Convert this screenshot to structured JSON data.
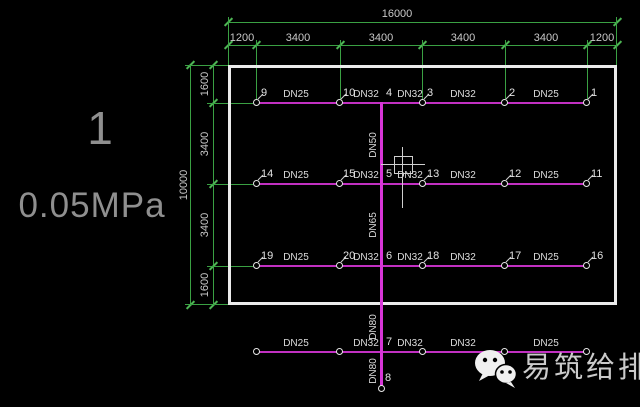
{
  "drawing": {
    "annotation": {
      "riser_id": "1",
      "pressure": "0.05MPa"
    },
    "dims_top": {
      "overall": "16000",
      "segments": [
        "1200",
        "3400",
        "3400",
        "3400",
        "3400",
        "1200"
      ]
    },
    "dims_left": {
      "overall": "10000",
      "segments": [
        "1600",
        "3400",
        "3400",
        "1600"
      ]
    },
    "rows": [
      {
        "nodes": [
          "9",
          "10",
          "3",
          "2",
          "1"
        ],
        "junction": "4",
        "segments": [
          "DN25",
          "DN32",
          "DN32",
          "DN32",
          "DN25"
        ]
      },
      {
        "nodes": [
          "14",
          "15",
          "13",
          "12",
          "11"
        ],
        "junction": "5",
        "segments": [
          "DN25",
          "DN32",
          "DN32",
          "DN32",
          "DN25"
        ]
      },
      {
        "nodes": [
          "19",
          "20",
          "18",
          "17",
          "16"
        ],
        "junction": "6",
        "segments": [
          "DN25",
          "DN32",
          "DN32",
          "DN32",
          "DN25"
        ]
      },
      {
        "nodes": [
          "",
          "",
          "",
          "",
          ""
        ],
        "junction": "7",
        "segments": [
          "DN25",
          "DN32",
          "DN32",
          "DN32",
          "DN25"
        ]
      }
    ],
    "riser": {
      "segments": [
        "DN50",
        "DN65",
        "DN80",
        "DN80"
      ],
      "end_node": "8"
    },
    "colors": {
      "dimension_green": "#3aa143",
      "pipe_magenta": "#c230c2",
      "riser_magenta": "#d836d8",
      "outline_white": "#ebebeb",
      "text_gray": "#8f8f8f"
    }
  },
  "watermark": {
    "label": "易筑给排水",
    "icon": "wechat-icon"
  }
}
